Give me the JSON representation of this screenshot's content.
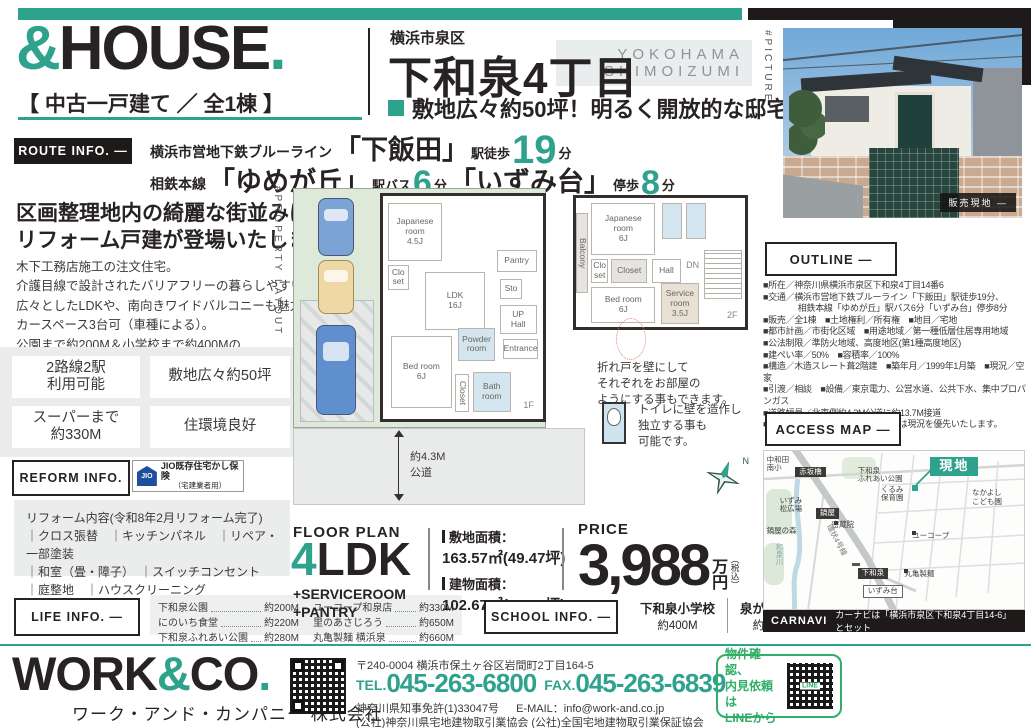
{
  "colors": {
    "accent": "#2EA28D",
    "dark": "#1d1a19",
    "panel_gray": "#ebeded",
    "line_green": "#2fae66",
    "jio_blue": "#1d4f9e"
  },
  "header": {
    "brand": {
      "amp": "&",
      "name": "HOUSE",
      "dot": ".",
      "subtitle": "【 中古一戸建て ／ 全1棟 】"
    },
    "area_small": "横浜市泉区",
    "area_large": "下和泉4丁目",
    "romaji": [
      "YOKOHAMA",
      "SHIMOIZUMI"
    ],
    "catch": "敷地広々約50坪！明るく開放的な邸宅",
    "picture_tag": "#PICTURE",
    "photo_badge": "販売現地 —"
  },
  "route_info": {
    "label": "ROUTE INFO. —",
    "line1": {
      "prefix": "横浜市営地下鉄ブルーライン",
      "station": "「下飯田」",
      "mode": "駅徒歩",
      "minutes": "19",
      "unit": "分"
    },
    "line2": {
      "prefix": "相鉄本線",
      "station1": "「ゆめが丘」",
      "mode1": "駅バス",
      "minutes1": "6",
      "unit1": "分",
      "station2": "「いずみ台」",
      "mode2": "停歩",
      "minutes2": "8",
      "unit2": "分"
    }
  },
  "intro": {
    "headline": [
      "区画整理地内の綺麗な街並みに",
      "リフォーム戸建が登場いたしました！"
    ],
    "body": [
      "木下工務店施工の注文住宅。",
      "介護目線で設計されたバリアフリーの暮らしやすい住宅です。",
      "広々としたLDKや、南向きワイドバルコニーも魅力。",
      "カースペース3台可（車種による）。",
      "公園まで約200M＆小学校まで約400Mの",
      "子育て世帯にも嬉しいエリアです。"
    ],
    "feature_boxes": [
      "2路線2駅\n利用可能",
      "敷地広々約50坪",
      "スーパーまで\n約330M",
      "住環境良好"
    ]
  },
  "reform": {
    "label": "REFORM INFO.",
    "jio": {
      "icon_text": "JIO",
      "title": "JIO既存住宅かし保険",
      "sub": "（宅建業者用）"
    },
    "title": "リフォーム内容(令和8年2月リフォーム完了)",
    "lines": [
      "｜クロス張替　｜キッチンパネル　｜リペア・一部塗装",
      "｜和室（畳・障子）　｜スイッチコンセント",
      "｜庭整地　｜ハウスクリーニング"
    ]
  },
  "life_info": {
    "label": "LIFE INFO. —",
    "items": [
      {
        "name": "下和泉公園",
        "dist": "約200M"
      },
      {
        "name": "にのいち食堂",
        "dist": "約220M"
      },
      {
        "name": "下和泉ふれあい公園",
        "dist": "約280M"
      },
      {
        "name": "ユーコープ和泉店",
        "dist": "約330M"
      },
      {
        "name": "里のあさじろう",
        "dist": "約650M"
      },
      {
        "name": "丸亀製麺 横浜泉",
        "dist": "約660M"
      }
    ]
  },
  "floor_plan": {
    "side_tag": "#PROPERTY LAYOUT",
    "label": "FLOOR PLAN",
    "ldk": {
      "num": "4",
      "suffix": "LDK",
      "plus": [
        "+SERVICEROOM",
        "+PANTRY"
      ]
    },
    "land_label": "敷地面積：",
    "land_value": "163.57㎡(49.47坪)",
    "bldg_label": "建物面積：",
    "bldg_value": "102.67㎡(31.05坪)",
    "road_note": [
      "約4.3M",
      "公道"
    ],
    "note1": [
      "折れ戸を壁にして",
      "それぞれをお部屋の",
      "ようにする事もできます。"
    ],
    "note2": [
      "トイレに壁を造作し",
      "独立する事も",
      "可能です。"
    ],
    "compass_n": "N",
    "rooms_1f": [
      {
        "t": "Japanese\nroom\n4.5J",
        "x": 3,
        "y": 3,
        "w": 34,
        "h": 26
      },
      {
        "t": "Clo\nset",
        "x": 3,
        "y": 31,
        "w": 13,
        "h": 11
      },
      {
        "t": "LDK\n16J",
        "x": 26,
        "y": 34,
        "w": 38,
        "h": 26
      },
      {
        "t": "Pantry",
        "x": 71,
        "y": 24,
        "w": 25,
        "h": 10
      },
      {
        "t": "Sto",
        "x": 73,
        "y": 37,
        "w": 14,
        "h": 9
      },
      {
        "t": "UP\nHall",
        "x": 73,
        "y": 49,
        "w": 23,
        "h": 13
      },
      {
        "t": "Entrance",
        "x": 75,
        "y": 64,
        "w": 22,
        "h": 9
      },
      {
        "t": "Powder\nroom",
        "x": 47,
        "y": 59,
        "w": 23,
        "h": 15,
        "c": "wet"
      },
      {
        "t": "Bed room\n6J",
        "x": 5,
        "y": 63,
        "w": 38,
        "h": 32
      },
      {
        "t": "Closet",
        "x": 45,
        "y": 80,
        "w": 9,
        "h": 17,
        "c": "vert"
      },
      {
        "t": "Bath\nroom",
        "x": 56,
        "y": 79,
        "w": 24,
        "h": 18,
        "c": "wet"
      },
      {
        "t": "1F",
        "x": 84,
        "y": 90,
        "w": 14,
        "h": 8,
        "c": "tag"
      }
    ],
    "rooms_2f": [
      {
        "t": "Balcony",
        "x": 0,
        "y": 12,
        "w": 7,
        "h": 62,
        "c": "vert gray"
      },
      {
        "t": "Japanese\nroom\n6J",
        "x": 9,
        "y": 4,
        "w": 38,
        "h": 40
      },
      {
        "t": "",
        "x": 51,
        "y": 4,
        "w": 12,
        "h": 28,
        "c": "wet"
      },
      {
        "t": "",
        "x": 65,
        "y": 4,
        "w": 12,
        "h": 28,
        "c": "wet"
      },
      {
        "t": "Clo\nset",
        "x": 9,
        "y": 47,
        "w": 10,
        "h": 19
      },
      {
        "t": "Closet",
        "x": 21,
        "y": 47,
        "w": 21,
        "h": 19,
        "c": "gray"
      },
      {
        "t": "Hall",
        "x": 45,
        "y": 47,
        "w": 17,
        "h": 19
      },
      {
        "t": "DN",
        "x": 64,
        "y": 47,
        "w": 10,
        "h": 10,
        "c": "tag"
      },
      {
        "t": "",
        "x": 76,
        "y": 40,
        "w": 22,
        "h": 38,
        "c": "stairs"
      },
      {
        "t": "Bed room\n6J",
        "x": 9,
        "y": 69,
        "w": 38,
        "h": 28
      },
      {
        "t": "Service\nroom\n3.5J",
        "x": 50,
        "y": 66,
        "w": 23,
        "h": 32,
        "c": "beige"
      },
      {
        "t": "2F",
        "x": 86,
        "y": 86,
        "w": 13,
        "h": 10,
        "c": "tag"
      }
    ]
  },
  "price": {
    "label": "PRICE",
    "value": "3,988",
    "unit_top": "万",
    "unit_bottom": "円",
    "tax": "（税込）"
  },
  "school_info": {
    "label": "SCHOOL INFO. —",
    "items": [
      {
        "name": "下和泉小学校",
        "dist": "約400M"
      },
      {
        "name": "泉が丘中学校",
        "dist": "約1,100M"
      }
    ]
  },
  "outline": {
    "label": "OUTLINE —",
    "rows": [
      "■所在／神奈川県横浜市泉区下和泉4丁目14番6",
      "■交通／横浜市営地下鉄ブルーライン「下飯田」駅徒歩19分、",
      "　　　　相鉄本線「ゆめが丘」駅バス6分「いずみ台」停歩8分",
      "■販売／全1棟　■土地権利／所有権　■地目／宅地",
      "■都市計画／市街化区域　■用途地域／第一種低層住居専用地域",
      "■公法制限／準防火地域、高度地区(第1種高度地区)",
      "■建ぺい率／50%　■容積率／100%",
      "■構造／木造スレート葺2階建　■築年月／1999年1月築　■現況／空家",
      "■引渡／相談　■設備／東京電力、公営水道、公共下水、集中プロパンガス",
      "■道路幅員／北東側約4.3M公道に約13.7M接道",
      "■備考／図面と現況が相違する場合は現況を優先いたします。"
    ]
  },
  "access_map": {
    "label": "ACCESS MAP —",
    "carnavi_label": "CARNAVI",
    "carnavi_text": "カーナビは「横浜市泉区下和泉4丁目14-6」とセット",
    "labels": [
      {
        "text": "中和田\n南小",
        "style": "",
        "x": 1,
        "y": 3
      },
      {
        "text": "赤坂橋",
        "style": "dark",
        "x": 12,
        "y": 10
      },
      {
        "text": "下和泉\nふれあい公園",
        "style": "",
        "x": 36,
        "y": 10
      },
      {
        "text": "くるみ\n保育園",
        "style": "",
        "x": 45,
        "y": 22
      },
      {
        "text": "現地",
        "style": "site",
        "x": 64,
        "y": 4
      },
      {
        "text": "なかよし\nこども園",
        "style": "",
        "x": 80,
        "y": 24
      },
      {
        "text": "いずみ\n松広場",
        "style": "",
        "x": 6,
        "y": 29
      },
      {
        "text": "鍋屋",
        "style": "dark",
        "x": 20,
        "y": 36
      },
      {
        "text": "密蔵院",
        "style": "",
        "x": 26,
        "y": 44
      },
      {
        "text": "鍋屋の森",
        "style": "",
        "x": 1,
        "y": 48
      },
      {
        "text": "和泉川",
        "style": "river",
        "x": 4,
        "y": 58
      },
      {
        "text": "環状4号線",
        "style": "road",
        "x": 21,
        "y": 54
      },
      {
        "text": "ユーコープ",
        "style": "",
        "x": 57,
        "y": 51
      },
      {
        "text": "下和泉",
        "style": "dark",
        "x": 36,
        "y": 74
      },
      {
        "text": "いずみ台",
        "style": "box",
        "x": 38,
        "y": 85
      },
      {
        "text": "丸亀製麺",
        "style": "",
        "x": 54,
        "y": 75
      }
    ]
  },
  "footer": {
    "logo": {
      "p1": "WORK",
      "amp": "&",
      "p2": "CO",
      "dot": "."
    },
    "company_jp": "ワーク・アンド・カンパニー 株式会社",
    "address": "〒240-0004 横浜市保土ヶ谷区岩間町2丁目164-5",
    "tel_label": "TEL.",
    "tel": "045-263-6800",
    "fax_label": "FAX.",
    "fax": "045-263-6839",
    "license": "神奈川県知事免許(1)33047号",
    "email_label": "E-MAIL：",
    "email": "info@work-and.co.jp",
    "associations": "(公社)神奈川県宅地建物取引業協会 (公社)全国宅地建物取引業保証協会",
    "line_note": [
      "物件確認、",
      "内見依頼は",
      "LINEから"
    ],
    "line_qr_text": "LINE"
  }
}
